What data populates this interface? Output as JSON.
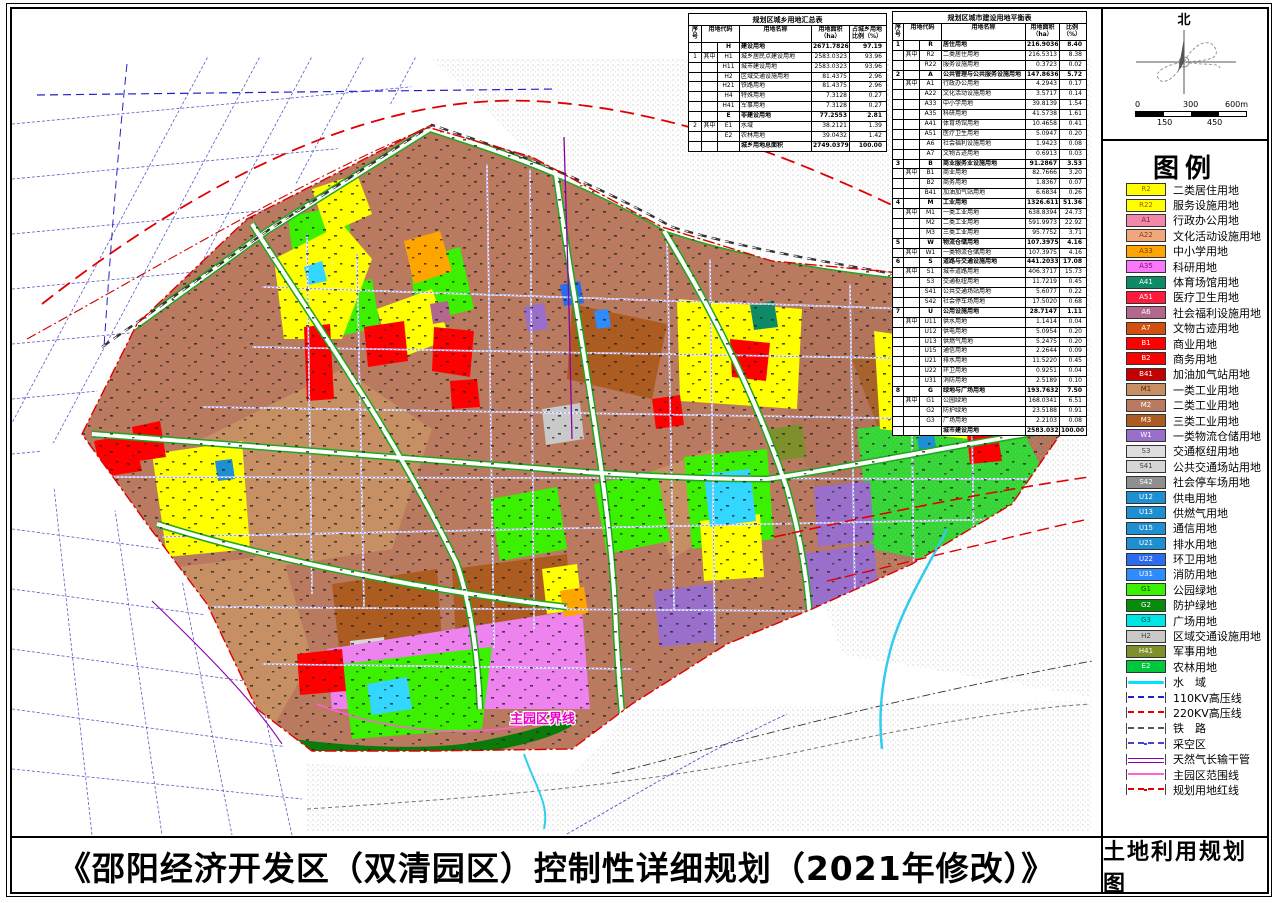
{
  "sheet": {
    "title": "《邵阳经济开发区（双清园区）控制性详细规划（2021年修改）》",
    "map_title": "土地利用规划图"
  },
  "compass": {
    "north": "北"
  },
  "scalebar": {
    "t0": "0",
    "t1": "300",
    "t2": "600m",
    "b0": "150",
    "b1": "450"
  },
  "map": {
    "annotation": "主园区界线"
  },
  "legend": {
    "title": "图例",
    "swatches": [
      {
        "code": "R2",
        "label": "二类居住用地",
        "color": "#FFFF00",
        "tc": "#A05A00"
      },
      {
        "code": "R22",
        "label": "服务设施用地",
        "color": "#FFFF00",
        "tc": "#A05A00"
      },
      {
        "code": "A1",
        "label": "行政办公用地",
        "color": "#F287A8",
        "tc": "#7A2040"
      },
      {
        "code": "A22",
        "label": "文化活动设施用地",
        "color": "#F2A87D",
        "tc": "#7A4020"
      },
      {
        "code": "A33",
        "label": "中小学用地",
        "color": "#FFA500",
        "tc": "#7A4000"
      },
      {
        "code": "A35",
        "label": "科研用地",
        "color": "#FA78FA",
        "tc": "#781078"
      },
      {
        "code": "A41",
        "label": "体育场馆用地",
        "color": "#0E8A66",
        "tc": "#FFFFFF"
      },
      {
        "code": "A51",
        "label": "医疗卫生用地",
        "color": "#FF1A3C",
        "tc": "#FFFFFF"
      },
      {
        "code": "A6",
        "label": "社会福利设施用地",
        "color": "#B2688C",
        "tc": "#FFFFFF"
      },
      {
        "code": "A7",
        "label": "文物古迹用地",
        "color": "#D2500F",
        "tc": "#FFFFFF"
      },
      {
        "code": "B1",
        "label": "商业用地",
        "color": "#FF0000",
        "tc": "#FFFFFF"
      },
      {
        "code": "B2",
        "label": "商务用地",
        "color": "#F80400",
        "tc": "#FFFFFF"
      },
      {
        "code": "B41",
        "label": "加油加气站用地",
        "color": "#C40000",
        "tc": "#FFFFFF"
      },
      {
        "code": "M1",
        "label": "一类工业用地",
        "color": "#C69064",
        "tc": "#502810"
      },
      {
        "code": "M2",
        "label": "二类工业用地",
        "color": "#B97A5F",
        "tc": "#FFFFFF"
      },
      {
        "code": "M3",
        "label": "三类工业用地",
        "color": "#AC5C20",
        "tc": "#FFFFFF"
      },
      {
        "code": "W1",
        "label": "一类物流仓储用地",
        "color": "#9A6ECB",
        "tc": "#FFFFFF"
      },
      {
        "code": "S3",
        "label": "交通枢纽用地",
        "color": "#DEDEDE",
        "tc": "#444444"
      },
      {
        "code": "S41",
        "label": "公共交通场站用地",
        "color": "#D6D6D6",
        "tc": "#444444"
      },
      {
        "code": "S42",
        "label": "社会停车场用地",
        "color": "#8F8F8F",
        "tc": "#FFFFFF"
      },
      {
        "code": "U12",
        "label": "供电用地",
        "color": "#1E8FD0",
        "tc": "#FFFFFF"
      },
      {
        "code": "U13",
        "label": "供燃气用地",
        "color": "#1E8FD0",
        "tc": "#FFFFFF"
      },
      {
        "code": "U15",
        "label": "通信用地",
        "color": "#1E8FD0",
        "tc": "#FFFFFF"
      },
      {
        "code": "U21",
        "label": "排水用地",
        "color": "#1E8FD0",
        "tc": "#FFFFFF"
      },
      {
        "code": "U22",
        "label": "环卫用地",
        "color": "#2B6BF0",
        "tc": "#FFFFFF"
      },
      {
        "code": "U31",
        "label": "消防用地",
        "color": "#2E8CFF",
        "tc": "#FFFFFF"
      },
      {
        "code": "G1",
        "label": "公园绿地",
        "color": "#3BF000",
        "tc": "#064d06"
      },
      {
        "code": "G2",
        "label": "防护绿地",
        "color": "#0A8A0A",
        "tc": "#FFFFFF"
      },
      {
        "code": "G3",
        "label": "广场用地",
        "color": "#00E6E6",
        "tc": "#005555"
      },
      {
        "code": "H2",
        "label": "区域交通设施用地",
        "color": "#C9C9C9",
        "tc": "#444444"
      },
      {
        "code": "H41",
        "label": "军事用地",
        "color": "#7E8F2B",
        "tc": "#FFFFFF"
      },
      {
        "code": "E2",
        "label": "农林用地",
        "color": "#00C83C",
        "tc": "#FFFFFF"
      }
    ],
    "lines": [
      {
        "label": "水　域",
        "color": "#00E0FF",
        "cls": "ln-wavy"
      },
      {
        "label": "110KV高压线",
        "color": "#2222CC",
        "cls": "ln-dash"
      },
      {
        "label": "220KV高压线",
        "color": "#E00000",
        "cls": "ln-dash"
      },
      {
        "label": "铁　路",
        "color": "#555555",
        "cls": "ln-dash"
      },
      {
        "label": "采空区",
        "color": "#4444CC",
        "cls": "ln-dashdot"
      },
      {
        "label": "天然气长输干管",
        "color": "#8A00A8",
        "cls": "ln-double"
      },
      {
        "label": "主园区范围线",
        "color": "#FF66CC",
        "cls": "ln-solid"
      },
      {
        "label": "规划用地红线",
        "color": "#E00000",
        "cls": "ln-dashdot"
      }
    ]
  },
  "table1": {
    "title": "规划区城乡用地汇总表",
    "headers": [
      "序号",
      "用地代码",
      "用地名称",
      "用地面积（ha）",
      "占城乡用地比例（%）"
    ],
    "rows": [
      {
        "s": "",
        "z": "",
        "c": "H",
        "n": "建设用地",
        "a": "2671.7826",
        "p": "97.19",
        "cls": "bold"
      },
      {
        "s": "1",
        "z": "其中",
        "c": "H1",
        "n": "城乡居民点建设用地",
        "a": "2583.0323",
        "p": "93.96",
        "cls": ""
      },
      {
        "s": "",
        "z": "",
        "c": "H11",
        "n": "城市建设用地",
        "a": "2583.0323",
        "p": "93.96",
        "cls": ""
      },
      {
        "s": "",
        "z": "",
        "c": "H2",
        "n": "区域交通设施用地",
        "a": "81.4375",
        "p": "2.96",
        "cls": ""
      },
      {
        "s": "",
        "z": "",
        "c": "H21",
        "n": "铁路用地",
        "a": "81.4375",
        "p": "2.96",
        "cls": ""
      },
      {
        "s": "",
        "z": "",
        "c": "H4",
        "n": "特殊用地",
        "a": "7.3128",
        "p": "0.27",
        "cls": ""
      },
      {
        "s": "",
        "z": "",
        "c": "H41",
        "n": "军事用地",
        "a": "7.3128",
        "p": "0.27",
        "cls": ""
      },
      {
        "s": "",
        "z": "",
        "c": "E",
        "n": "非建设用地",
        "a": "77.2553",
        "p": "2.81",
        "cls": "bold"
      },
      {
        "s": "2",
        "z": "其中",
        "c": "E1",
        "n": "水域",
        "a": "38.2121",
        "p": "1.39",
        "cls": ""
      },
      {
        "s": "",
        "z": "",
        "c": "E2",
        "n": "农林用地",
        "a": "39.0432",
        "p": "1.42",
        "cls": ""
      },
      {
        "s": "",
        "z": "",
        "c": "",
        "n": "城乡用地总面积",
        "a": "2749.0379",
        "p": "100.00",
        "cls": "bold"
      }
    ]
  },
  "table2": {
    "title": "规划区城市建设用地平衡表",
    "headers": [
      "序号",
      "用地代码",
      "用地名称",
      "用地面积（ha）",
      "比例（%）"
    ],
    "rows": [
      {
        "s": "1",
        "z": "",
        "c": "R",
        "n": "居住用地",
        "a": "216.9036",
        "p": "8.40",
        "cls": "bold"
      },
      {
        "s": "",
        "z": "其中",
        "c": "R2",
        "n": "二类居住用地",
        "a": "216.5313",
        "p": "8.38",
        "cls": ""
      },
      {
        "s": "",
        "z": "",
        "c": "R22",
        "n": "服务设施用地",
        "a": "0.3723",
        "p": "0.02",
        "cls": ""
      },
      {
        "s": "2",
        "z": "",
        "c": "A",
        "n": "公共管理与公共服务设施用地",
        "a": "147.8636",
        "p": "5.72",
        "cls": "bold"
      },
      {
        "s": "",
        "z": "其中",
        "c": "A1",
        "n": "行政办公用地",
        "a": "4.2943",
        "p": "0.17",
        "cls": ""
      },
      {
        "s": "",
        "z": "",
        "c": "A22",
        "n": "文化活动设施用地",
        "a": "3.5717",
        "p": "0.14",
        "cls": ""
      },
      {
        "s": "",
        "z": "",
        "c": "A33",
        "n": "中小学用地",
        "a": "39.8139",
        "p": "1.54",
        "cls": ""
      },
      {
        "s": "",
        "z": "",
        "c": "A35",
        "n": "科研用地",
        "a": "41.5738",
        "p": "1.61",
        "cls": ""
      },
      {
        "s": "",
        "z": "",
        "c": "A41",
        "n": "体育场馆用地",
        "a": "10.4658",
        "p": "0.41",
        "cls": ""
      },
      {
        "s": "",
        "z": "",
        "c": "A51",
        "n": "医疗卫生用地",
        "a": "5.0947",
        "p": "0.20",
        "cls": ""
      },
      {
        "s": "",
        "z": "",
        "c": "A6",
        "n": "社会福利设施用地",
        "a": "1.9423",
        "p": "0.08",
        "cls": ""
      },
      {
        "s": "",
        "z": "",
        "c": "A7",
        "n": "文物古迹用地",
        "a": "0.6913",
        "p": "0.03",
        "cls": ""
      },
      {
        "s": "3",
        "z": "",
        "c": "B",
        "n": "商业服务业设施用地",
        "a": "91.2867",
        "p": "3.53",
        "cls": "bold"
      },
      {
        "s": "",
        "z": "其中",
        "c": "B1",
        "n": "商业用地",
        "a": "82.7666",
        "p": "3.20",
        "cls": ""
      },
      {
        "s": "",
        "z": "",
        "c": "B2",
        "n": "商务用地",
        "a": "1.8367",
        "p": "0.07",
        "cls": ""
      },
      {
        "s": "",
        "z": "",
        "c": "B41",
        "n": "加油加气站用地",
        "a": "6.6834",
        "p": "0.26",
        "cls": ""
      },
      {
        "s": "4",
        "z": "",
        "c": "M",
        "n": "工业用地",
        "a": "1326.6119",
        "p": "51.36",
        "cls": "bold"
      },
      {
        "s": "",
        "z": "其中",
        "c": "M1",
        "n": "一类工业用地",
        "a": "638.8394",
        "p": "24.73",
        "cls": ""
      },
      {
        "s": "",
        "z": "",
        "c": "M2",
        "n": "二类工业用地",
        "a": "591.9973",
        "p": "22.92",
        "cls": ""
      },
      {
        "s": "",
        "z": "",
        "c": "M3",
        "n": "三类工业用地",
        "a": "95.7752",
        "p": "3.71",
        "cls": ""
      },
      {
        "s": "5",
        "z": "",
        "c": "W",
        "n": "物流仓储用地",
        "a": "107.3975",
        "p": "4.16",
        "cls": "bold"
      },
      {
        "s": "",
        "z": "其中",
        "c": "W1",
        "n": "一类物流仓储用地",
        "a": "107.3975",
        "p": "4.16",
        "cls": ""
      },
      {
        "s": "6",
        "z": "",
        "c": "S",
        "n": "道路与交通设施用地",
        "a": "441.2033",
        "p": "17.08",
        "cls": "bold"
      },
      {
        "s": "",
        "z": "其中",
        "c": "S1",
        "n": "城市道路用地",
        "a": "406.3717",
        "p": "15.73",
        "cls": ""
      },
      {
        "s": "",
        "z": "",
        "c": "S3",
        "n": "交通枢纽用地",
        "a": "11.7219",
        "p": "0.45",
        "cls": ""
      },
      {
        "s": "",
        "z": "",
        "c": "S41",
        "n": "公共交通场站用地",
        "a": "5.6077",
        "p": "0.22",
        "cls": ""
      },
      {
        "s": "",
        "z": "",
        "c": "S42",
        "n": "社会停车场用地",
        "a": "17.5020",
        "p": "0.68",
        "cls": ""
      },
      {
        "s": "7",
        "z": "",
        "c": "U",
        "n": "公用设施用地",
        "a": "28.7147",
        "p": "1.11",
        "cls": "bold"
      },
      {
        "s": "",
        "z": "其中",
        "c": "U11",
        "n": "供水用地",
        "a": "1.1414",
        "p": "0.04",
        "cls": ""
      },
      {
        "s": "",
        "z": "",
        "c": "U12",
        "n": "供电用地",
        "a": "5.0954",
        "p": "0.20",
        "cls": ""
      },
      {
        "s": "",
        "z": "",
        "c": "U13",
        "n": "供燃气用地",
        "a": "5.2475",
        "p": "0.20",
        "cls": ""
      },
      {
        "s": "",
        "z": "",
        "c": "U15",
        "n": "通信用地",
        "a": "2.2644",
        "p": "0.09",
        "cls": ""
      },
      {
        "s": "",
        "z": "",
        "c": "U21",
        "n": "排水用地",
        "a": "11.5220",
        "p": "0.45",
        "cls": ""
      },
      {
        "s": "",
        "z": "",
        "c": "U22",
        "n": "环卫用地",
        "a": "0.9251",
        "p": "0.04",
        "cls": ""
      },
      {
        "s": "",
        "z": "",
        "c": "U31",
        "n": "消防用地",
        "a": "2.5189",
        "p": "0.10",
        "cls": ""
      },
      {
        "s": "8",
        "z": "",
        "c": "G",
        "n": "绿地与广场用地",
        "a": "193.7632",
        "p": "7.50",
        "cls": "bold"
      },
      {
        "s": "",
        "z": "其中",
        "c": "G1",
        "n": "公园绿地",
        "a": "168.0341",
        "p": "6.51",
        "cls": ""
      },
      {
        "s": "",
        "z": "",
        "c": "G2",
        "n": "防护绿地",
        "a": "23.5188",
        "p": "0.91",
        "cls": ""
      },
      {
        "s": "",
        "z": "",
        "c": "G3",
        "n": "广场用地",
        "a": "2.2103",
        "p": "0.08",
        "cls": ""
      },
      {
        "s": "",
        "z": "",
        "c": "",
        "n": "城市建设用地",
        "a": "2583.0323",
        "p": "100.00",
        "cls": "bold"
      }
    ]
  }
}
